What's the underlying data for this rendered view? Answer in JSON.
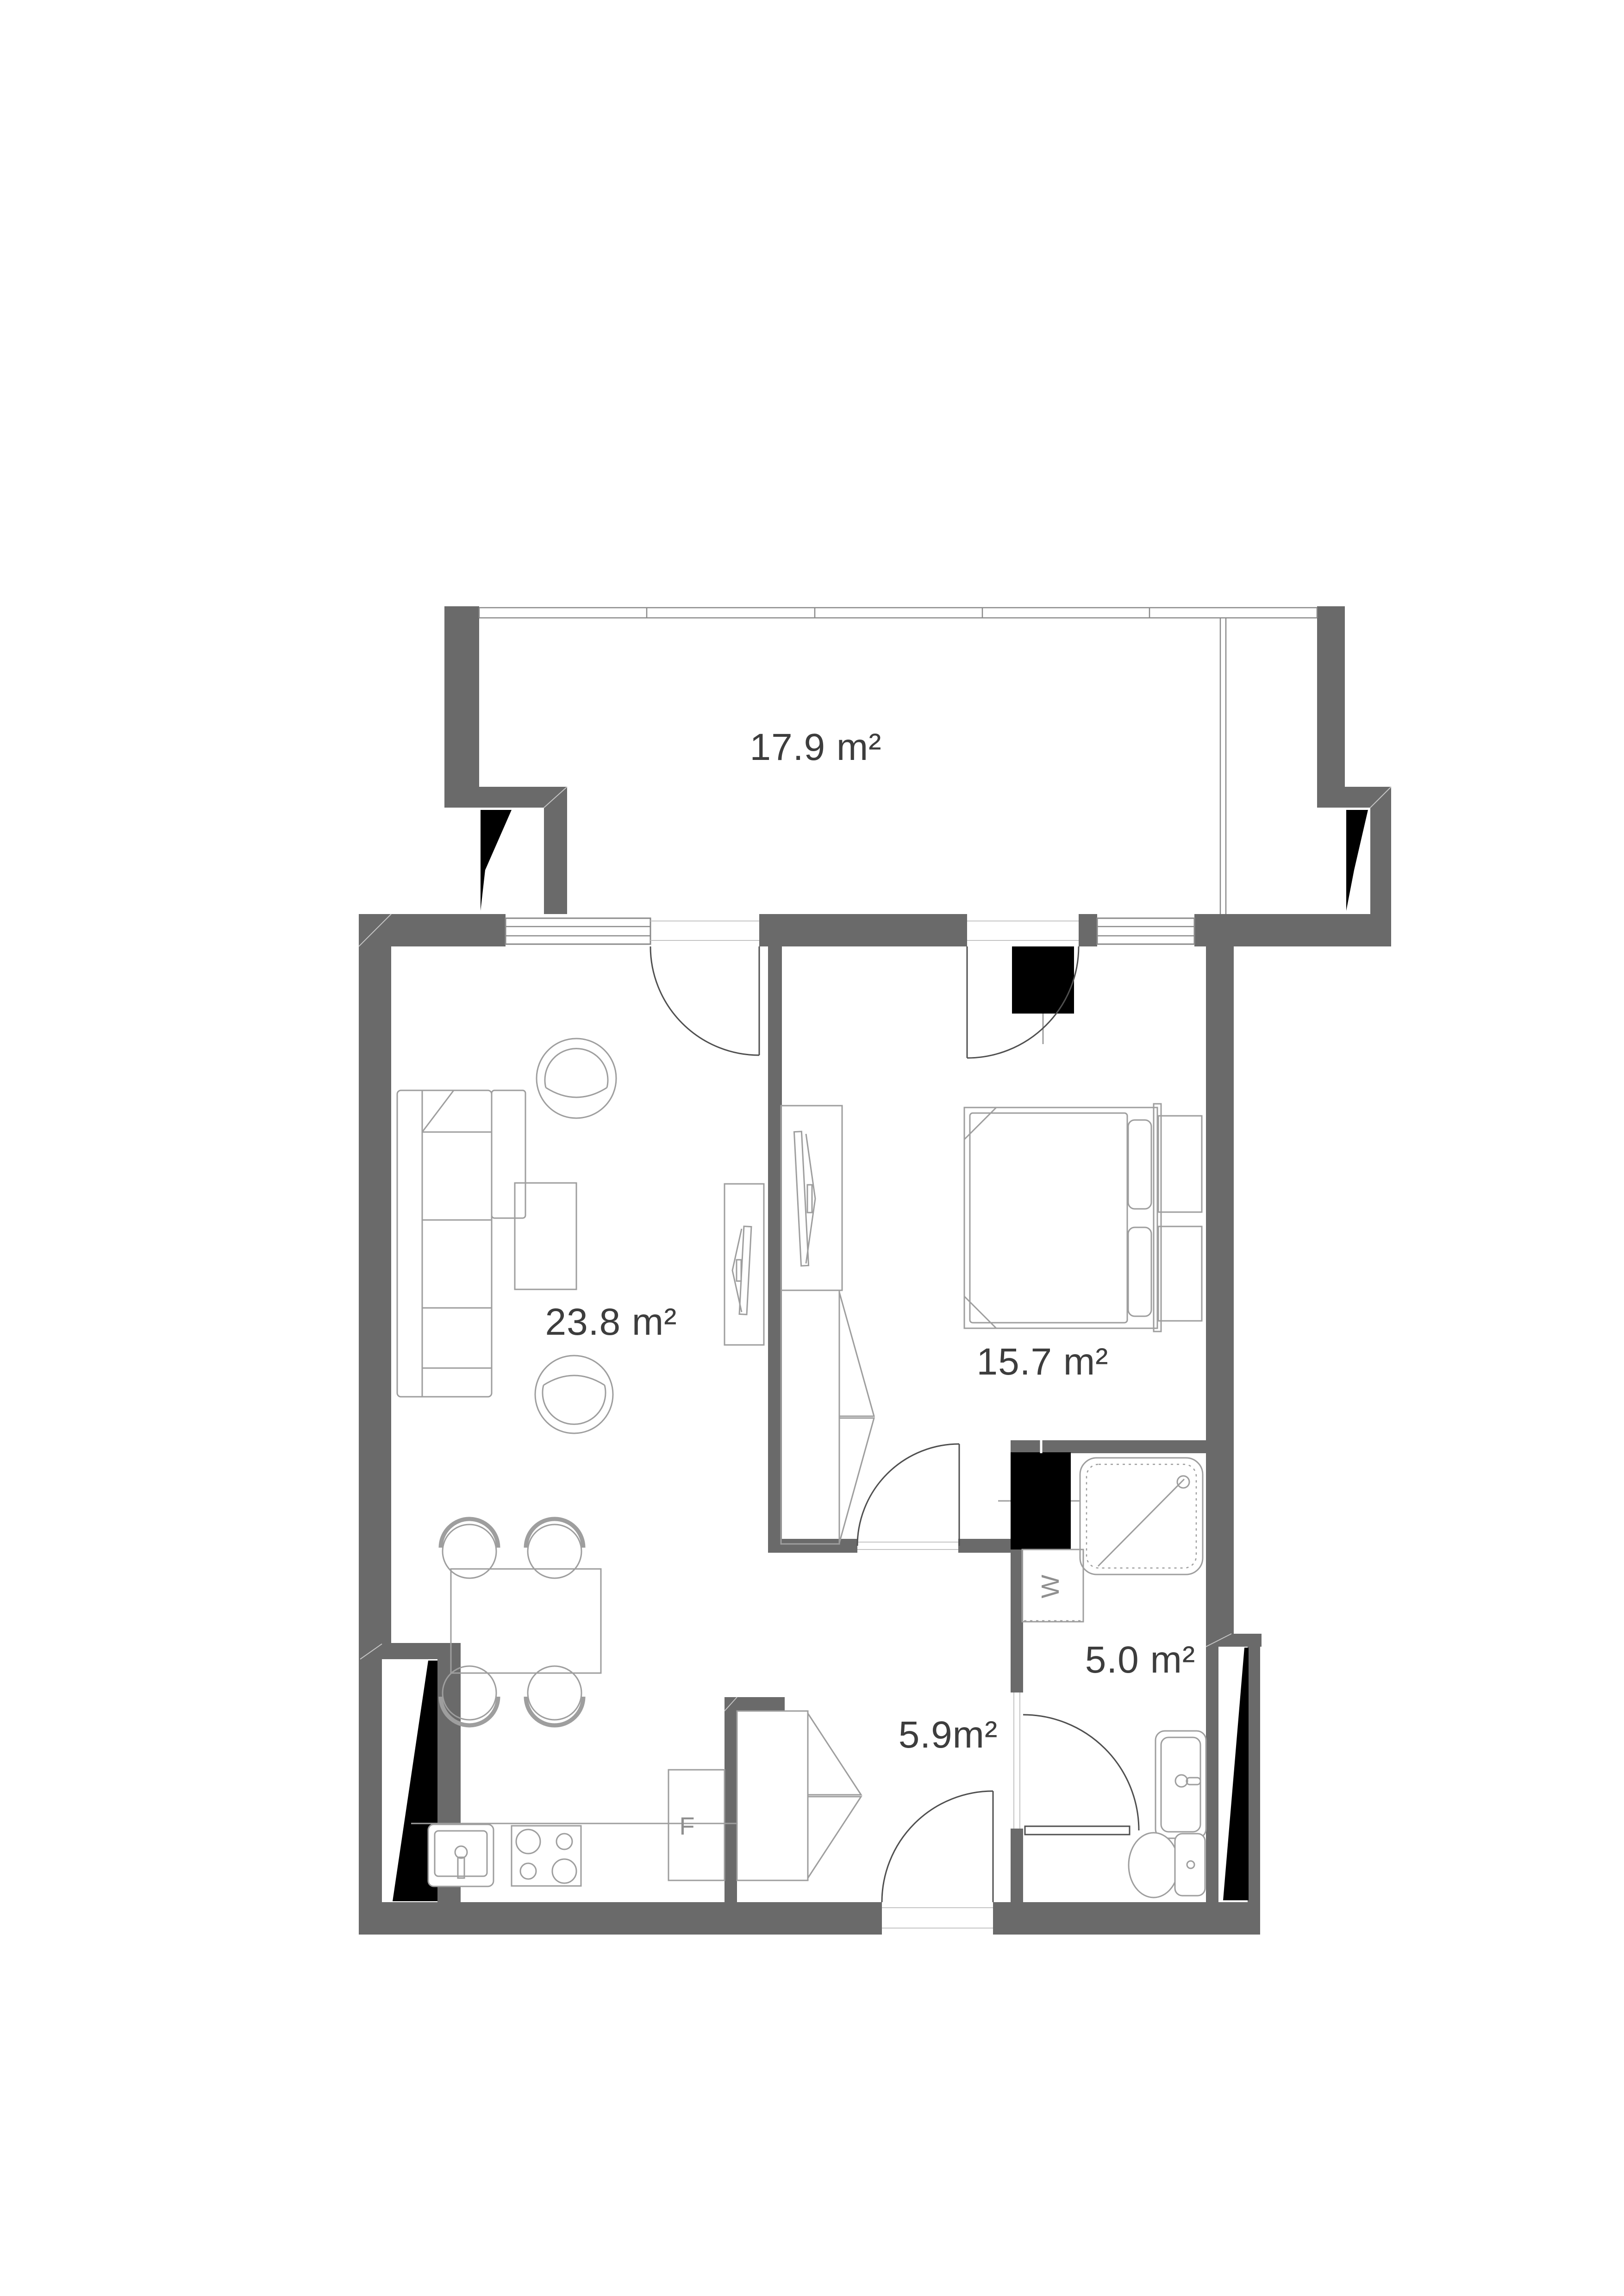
{
  "colors": {
    "background": "#ffffff",
    "wall": "#6a6a6a",
    "black": "#000000",
    "furniture-line": "#9e9e9e",
    "door-line": "#4f4f4f",
    "window-line": "#8a8a8a",
    "label": "#3d3d3d",
    "appliance-label": "#8f8f8f"
  },
  "areas": {
    "balcony": "17.9 m²",
    "living_room": "23.8 m²",
    "bedroom": "15.7 m²",
    "bathroom": "5.0 m²",
    "hallway": "5.9m²"
  },
  "appliances": {
    "fridge": "F",
    "washing_machine": "W"
  }
}
